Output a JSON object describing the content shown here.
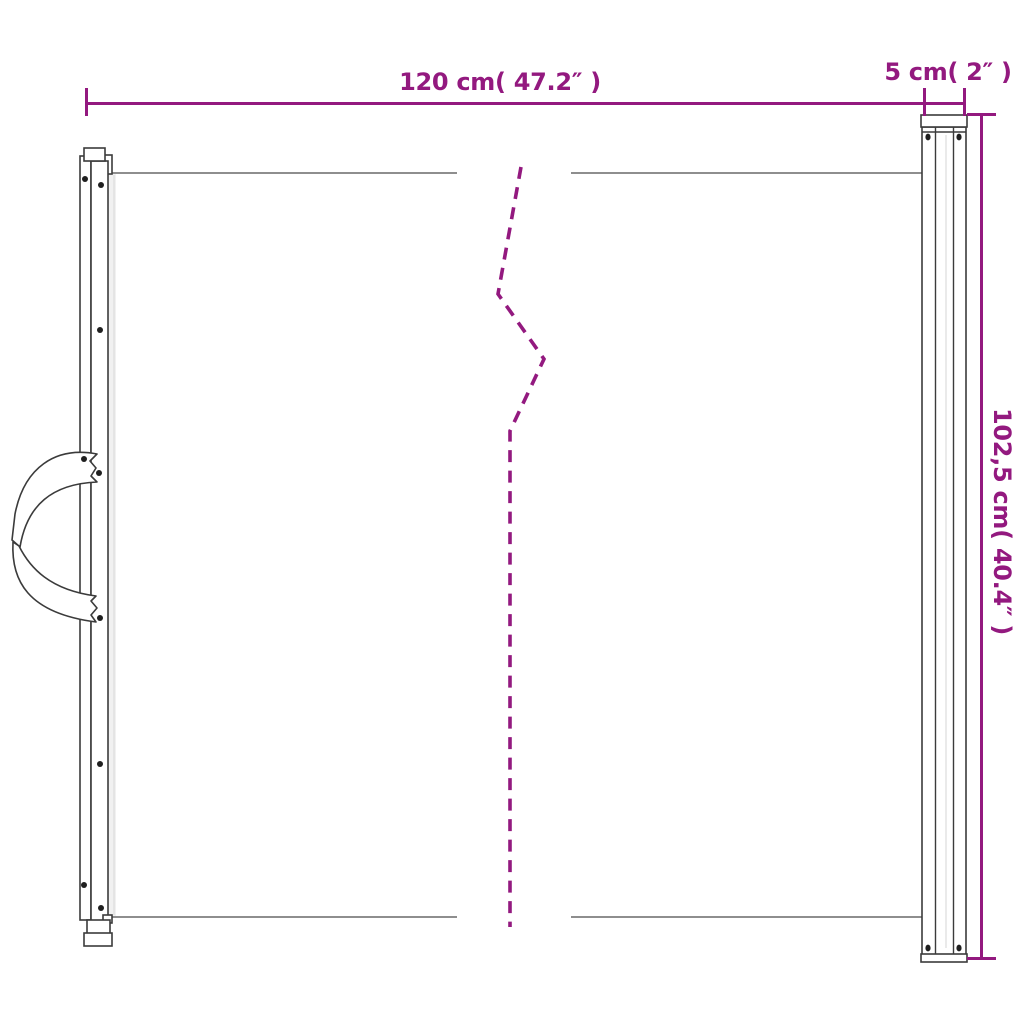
{
  "diagram": {
    "labels": {
      "width": "120 cm( 47.2″ )",
      "cassette_width": "5 cm( 2″ )",
      "height": "102,5 cm( 40.4″ )"
    },
    "colors": {
      "dimension_accent": "#93197F",
      "outline": "#3B3B3B",
      "mesh_line": "#7E7E7E",
      "background": "#FFFFFF"
    }
  }
}
